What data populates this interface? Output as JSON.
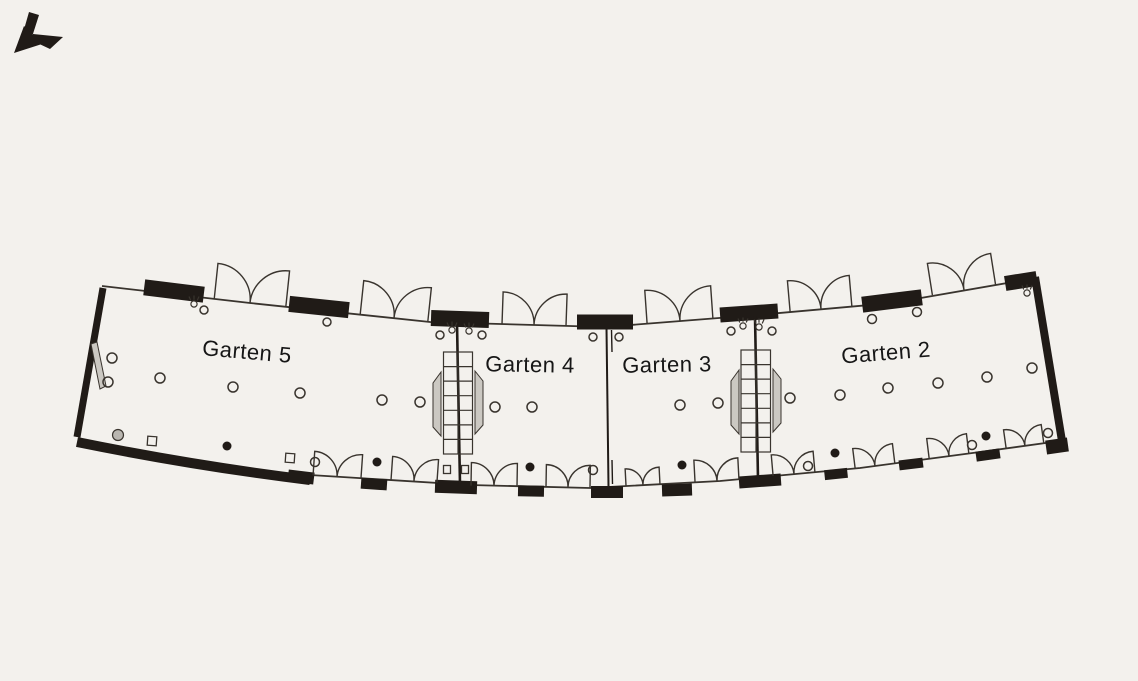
{
  "plan": {
    "rooms": [
      {
        "id": "garten-5",
        "label": "Garten 5"
      },
      {
        "id": "garten-4",
        "label": "Garten 4"
      },
      {
        "id": "garten-3",
        "label": "Garten 3"
      },
      {
        "id": "garten-2",
        "label": "Garten 2"
      }
    ]
  },
  "icons": [
    {
      "name": "north-arrow-icon",
      "glyph": "arrow pointing to lower-left"
    }
  ],
  "colors": {
    "bg": "#f3f1ed",
    "wall": "#201b17",
    "line": "#39342e",
    "gray": "#cbc8c2",
    "graydark": "#b9b6b0",
    "text": "#161616"
  }
}
